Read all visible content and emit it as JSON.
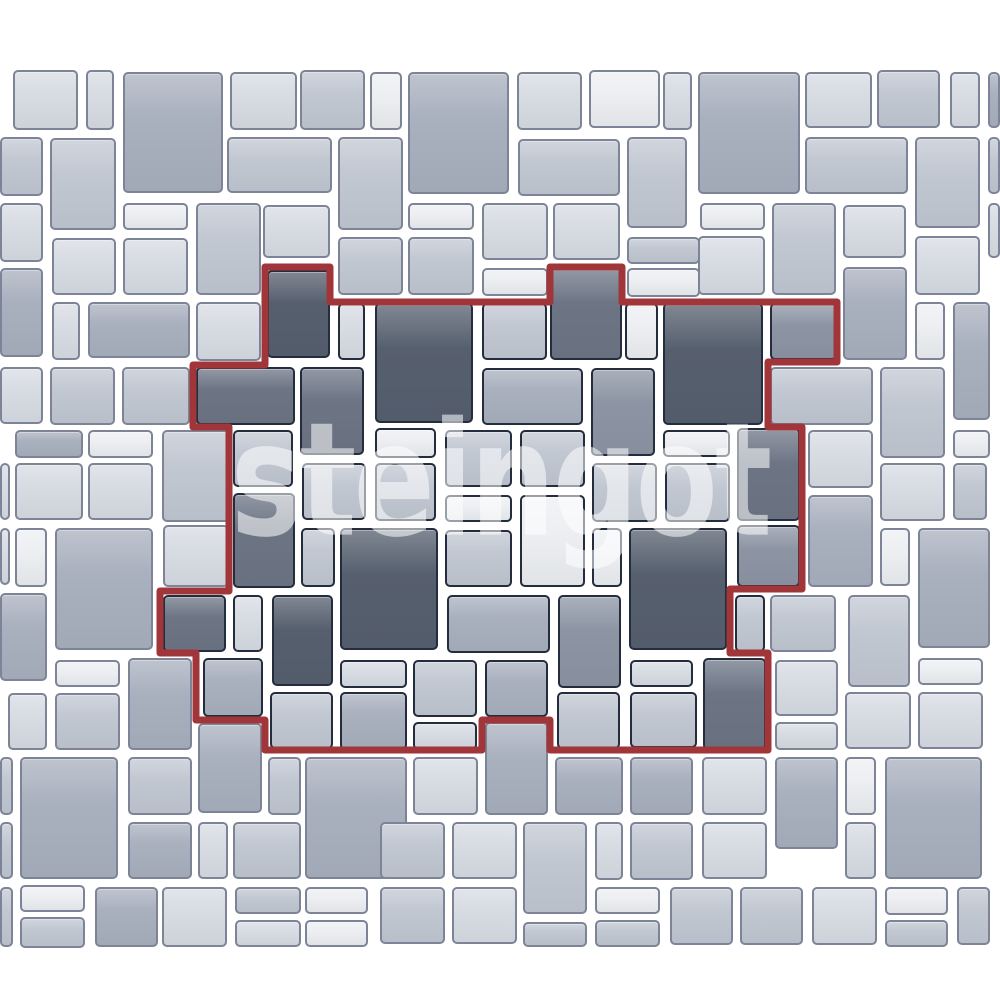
{
  "image": {
    "width": 1000,
    "height": 1000,
    "background": "#ffffff"
  },
  "watermark": {
    "text": "steingot"
  },
  "palette": {
    "shades": [
      "#edeff2",
      "#d8dce3",
      "#c2c8d2",
      "#a9b0be",
      "#8d95a4",
      "#6d7585",
      "#565f6e"
    ],
    "tile_border_outside": "#7d8497",
    "tile_border_inside": "#232d3d",
    "pattern_outline_red": "#a03639",
    "watermark_color": "rgba(255,255,255,0.55)"
  },
  "pattern_outline": {
    "stroke_width": 7,
    "points": [
      [
        265,
        267
      ],
      [
        330,
        267
      ],
      [
        330,
        302
      ],
      [
        550,
        302
      ],
      [
        550,
        267
      ],
      [
        622,
        267
      ],
      [
        622,
        302
      ],
      [
        837,
        302
      ],
      [
        837,
        362
      ],
      [
        768,
        362
      ],
      [
        768,
        427
      ],
      [
        802,
        427
      ],
      [
        802,
        589
      ],
      [
        730,
        589
      ],
      [
        730,
        653
      ],
      [
        768,
        653
      ],
      [
        768,
        750
      ],
      [
        550,
        750
      ],
      [
        550,
        720
      ],
      [
        482,
        720
      ],
      [
        482,
        750
      ],
      [
        265,
        750
      ],
      [
        265,
        720
      ],
      [
        196,
        720
      ],
      [
        196,
        653
      ],
      [
        160,
        653
      ],
      [
        160,
        591
      ],
      [
        229,
        591
      ],
      [
        229,
        427
      ],
      [
        193,
        427
      ],
      [
        193,
        365
      ],
      [
        265,
        365
      ]
    ]
  },
  "tiles": [
    [
      13,
      70,
      65,
      60,
      1,
      0
    ],
    [
      86,
      70,
      28,
      60,
      1,
      0
    ],
    [
      123,
      72,
      100,
      121,
      3,
      0
    ],
    [
      230,
      72,
      67,
      58,
      1,
      0
    ],
    [
      300,
      70,
      65,
      60,
      2,
      0
    ],
    [
      370,
      72,
      32,
      58,
      0,
      0
    ],
    [
      408,
      72,
      101,
      122,
      3,
      0
    ],
    [
      517,
      72,
      65,
      58,
      1,
      0
    ],
    [
      589,
      70,
      71,
      58,
      0,
      0
    ],
    [
      663,
      72,
      29,
      58,
      1,
      0
    ],
    [
      698,
      72,
      102,
      122,
      3,
      0
    ],
    [
      805,
      72,
      67,
      56,
      1,
      0
    ],
    [
      877,
      70,
      63,
      58,
      2,
      0
    ],
    [
      950,
      72,
      30,
      56,
      1,
      0
    ],
    [
      988,
      72,
      12,
      56,
      3,
      0
    ],
    [
      0,
      137,
      43,
      59,
      2,
      0
    ],
    [
      50,
      138,
      66,
      92,
      2,
      0
    ],
    [
      227,
      137,
      105,
      56,
      2,
      0
    ],
    [
      338,
      137,
      65,
      93,
      2,
      0
    ],
    [
      518,
      139,
      102,
      57,
      2,
      0
    ],
    [
      627,
      137,
      60,
      91,
      2,
      0
    ],
    [
      805,
      137,
      103,
      57,
      2,
      0
    ],
    [
      915,
      137,
      65,
      91,
      2,
      0
    ],
    [
      988,
      137,
      12,
      57,
      2,
      0
    ],
    [
      0,
      203,
      43,
      59,
      1,
      0
    ],
    [
      123,
      203,
      65,
      27,
      0,
      0
    ],
    [
      196,
      203,
      65,
      92,
      2,
      0
    ],
    [
      263,
      205,
      67,
      53,
      1,
      0
    ],
    [
      408,
      203,
      66,
      27,
      0,
      0
    ],
    [
      482,
      203,
      66,
      57,
      1,
      0
    ],
    [
      553,
      203,
      67,
      57,
      1,
      0
    ],
    [
      700,
      203,
      65,
      27,
      0,
      0
    ],
    [
      772,
      203,
      64,
      92,
      2,
      0
    ],
    [
      843,
      205,
      63,
      53,
      1,
      0
    ],
    [
      988,
      203,
      12,
      55,
      1,
      0
    ],
    [
      0,
      268,
      43,
      89,
      3,
      0
    ],
    [
      52,
      238,
      64,
      57,
      1,
      0
    ],
    [
      123,
      238,
      65,
      57,
      1,
      0
    ],
    [
      338,
      237,
      65,
      58,
      2,
      0
    ],
    [
      408,
      237,
      66,
      58,
      2,
      0
    ],
    [
      482,
      268,
      66,
      28,
      0,
      0
    ],
    [
      627,
      237,
      73,
      27,
      2,
      0
    ],
    [
      627,
      268,
      73,
      29,
      0,
      0
    ],
    [
      698,
      236,
      67,
      59,
      1,
      0
    ],
    [
      843,
      267,
      64,
      93,
      3,
      0
    ],
    [
      915,
      236,
      65,
      59,
      1,
      0
    ],
    [
      52,
      302,
      28,
      58,
      1,
      0
    ],
    [
      88,
      302,
      102,
      56,
      3,
      0
    ],
    [
      196,
      302,
      65,
      59,
      1,
      0
    ],
    [
      915,
      302,
      30,
      58,
      0,
      0
    ],
    [
      953,
      302,
      37,
      118,
      3,
      0
    ],
    [
      267,
      270,
      63,
      88,
      6,
      1
    ],
    [
      550,
      268,
      72,
      92,
      5,
      1
    ],
    [
      338,
      303,
      27,
      57,
      1,
      1
    ],
    [
      375,
      303,
      98,
      120,
      6,
      1
    ],
    [
      482,
      303,
      65,
      57,
      2,
      1
    ],
    [
      625,
      303,
      33,
      57,
      0,
      1
    ],
    [
      663,
      303,
      100,
      122,
      6,
      1
    ],
    [
      770,
      303,
      67,
      57,
      4,
      1
    ],
    [
      196,
      367,
      99,
      58,
      5,
      1
    ],
    [
      300,
      367,
      64,
      88,
      5,
      1
    ],
    [
      482,
      368,
      101,
      57,
      3,
      1
    ],
    [
      591,
      368,
      64,
      88,
      4,
      1
    ],
    [
      233,
      430,
      60,
      57,
      2,
      1
    ],
    [
      375,
      428,
      61,
      30,
      0,
      1
    ],
    [
      445,
      430,
      67,
      57,
      2,
      1
    ],
    [
      520,
      430,
      65,
      57,
      2,
      1
    ],
    [
      663,
      430,
      67,
      27,
      0,
      1
    ],
    [
      737,
      428,
      63,
      93,
      5,
      1
    ],
    [
      233,
      493,
      62,
      95,
      5,
      1
    ],
    [
      302,
      463,
      64,
      57,
      2,
      1
    ],
    [
      375,
      463,
      61,
      58,
      2,
      1
    ],
    [
      445,
      495,
      67,
      27,
      0,
      1
    ],
    [
      520,
      495,
      65,
      92,
      0,
      1
    ],
    [
      592,
      463,
      65,
      59,
      2,
      1
    ],
    [
      665,
      463,
      65,
      59,
      2,
      1
    ],
    [
      301,
      528,
      34,
      59,
      2,
      1
    ],
    [
      340,
      528,
      98,
      122,
      6,
      1
    ],
    [
      445,
      530,
      67,
      57,
      2,
      1
    ],
    [
      592,
      528,
      30,
      59,
      0,
      1
    ],
    [
      629,
      528,
      98,
      122,
      6,
      1
    ],
    [
      737,
      525,
      63,
      62,
      4,
      1
    ],
    [
      163,
      595,
      63,
      57,
      5,
      1
    ],
    [
      233,
      595,
      30,
      57,
      1,
      1
    ],
    [
      272,
      595,
      61,
      91,
      6,
      1
    ],
    [
      447,
      595,
      103,
      58,
      3,
      1
    ],
    [
      558,
      595,
      63,
      93,
      4,
      1
    ],
    [
      735,
      595,
      30,
      57,
      2,
      1
    ],
    [
      203,
      658,
      60,
      59,
      3,
      1
    ],
    [
      270,
      692,
      63,
      57,
      2,
      1
    ],
    [
      340,
      660,
      67,
      28,
      1,
      1
    ],
    [
      340,
      692,
      67,
      58,
      3,
      1
    ],
    [
      413,
      660,
      64,
      57,
      2,
      1
    ],
    [
      413,
      722,
      64,
      28,
      1,
      1
    ],
    [
      485,
      660,
      63,
      57,
      3,
      1
    ],
    [
      557,
      692,
      63,
      57,
      2,
      1
    ],
    [
      630,
      660,
      63,
      27,
      1,
      1
    ],
    [
      630,
      692,
      67,
      56,
      2,
      1
    ],
    [
      703,
      658,
      63,
      92,
      5,
      1
    ],
    [
      0,
      367,
      43,
      57,
      1,
      0
    ],
    [
      50,
      367,
      65,
      58,
      2,
      0
    ],
    [
      122,
      367,
      68,
      58,
      2,
      0
    ],
    [
      15,
      430,
      68,
      28,
      3,
      0
    ],
    [
      88,
      430,
      65,
      28,
      0,
      0
    ],
    [
      162,
      430,
      68,
      92,
      2,
      0
    ],
    [
      0,
      463,
      10,
      57,
      1,
      0
    ],
    [
      15,
      463,
      68,
      57,
      1,
      0
    ],
    [
      88,
      463,
      65,
      57,
      1,
      0
    ],
    [
      0,
      528,
      10,
      57,
      1,
      0
    ],
    [
      15,
      528,
      32,
      59,
      0,
      0
    ],
    [
      55,
      528,
      98,
      122,
      3,
      0
    ],
    [
      163,
      525,
      66,
      62,
      1,
      0
    ],
    [
      0,
      593,
      47,
      88,
      3,
      0
    ],
    [
      55,
      660,
      65,
      27,
      0,
      0
    ],
    [
      8,
      693,
      39,
      57,
      1,
      0
    ],
    [
      55,
      693,
      65,
      57,
      2,
      0
    ],
    [
      128,
      658,
      64,
      92,
      3,
      0
    ],
    [
      198,
      723,
      64,
      90,
      3,
      0
    ],
    [
      0,
      757,
      13,
      58,
      2,
      0
    ],
    [
      20,
      757,
      98,
      122,
      3,
      0
    ],
    [
      128,
      757,
      64,
      58,
      2,
      0
    ],
    [
      268,
      757,
      33,
      58,
      2,
      0
    ],
    [
      305,
      757,
      102,
      122,
      3,
      0
    ],
    [
      128,
      822,
      64,
      57,
      3,
      0
    ],
    [
      198,
      822,
      30,
      57,
      1,
      0
    ],
    [
      233,
      822,
      68,
      57,
      2,
      0
    ],
    [
      0,
      822,
      13,
      57,
      2,
      0
    ],
    [
      0,
      887,
      13,
      60,
      2,
      0
    ],
    [
      20,
      885,
      65,
      27,
      0,
      0
    ],
    [
      20,
      917,
      65,
      31,
      2,
      0
    ],
    [
      95,
      887,
      63,
      60,
      3,
      0
    ],
    [
      162,
      887,
      65,
      60,
      1,
      0
    ],
    [
      235,
      887,
      66,
      27,
      2,
      0
    ],
    [
      235,
      920,
      66,
      27,
      1,
      0
    ],
    [
      305,
      887,
      63,
      27,
      0,
      0
    ],
    [
      305,
      920,
      63,
      27,
      0,
      0
    ],
    [
      485,
      722,
      63,
      93,
      3,
      0
    ],
    [
      413,
      757,
      65,
      58,
      1,
      0
    ],
    [
      555,
      757,
      68,
      58,
      3,
      0
    ],
    [
      630,
      757,
      63,
      58,
      3,
      0
    ],
    [
      380,
      822,
      65,
      57,
      2,
      0
    ],
    [
      452,
      822,
      65,
      57,
      1,
      0
    ],
    [
      523,
      822,
      64,
      92,
      2,
      0
    ],
    [
      595,
      822,
      28,
      58,
      1,
      0
    ],
    [
      630,
      822,
      63,
      58,
      2,
      0
    ],
    [
      702,
      822,
      65,
      57,
      1,
      0
    ],
    [
      380,
      887,
      65,
      57,
      2,
      0
    ],
    [
      452,
      887,
      65,
      57,
      1,
      0
    ],
    [
      523,
      922,
      64,
      25,
      2,
      0
    ],
    [
      595,
      887,
      65,
      27,
      0,
      0
    ],
    [
      595,
      920,
      65,
      27,
      2,
      0
    ],
    [
      775,
      660,
      63,
      56,
      1,
      0
    ],
    [
      775,
      722,
      63,
      28,
      1,
      0
    ],
    [
      845,
      692,
      66,
      57,
      1,
      0
    ],
    [
      918,
      658,
      65,
      27,
      0,
      0
    ],
    [
      918,
      692,
      65,
      57,
      1,
      0
    ],
    [
      702,
      757,
      65,
      58,
      1,
      0
    ],
    [
      775,
      757,
      63,
      92,
      3,
      0
    ],
    [
      845,
      757,
      31,
      58,
      0,
      0
    ],
    [
      885,
      757,
      97,
      122,
      3,
      0
    ],
    [
      845,
      822,
      31,
      57,
      1,
      0
    ],
    [
      670,
      887,
      63,
      58,
      2,
      0
    ],
    [
      740,
      887,
      63,
      58,
      2,
      0
    ],
    [
      812,
      887,
      65,
      58,
      1,
      0
    ],
    [
      885,
      887,
      63,
      28,
      0,
      0
    ],
    [
      885,
      920,
      63,
      27,
      2,
      0
    ],
    [
      957,
      887,
      33,
      58,
      2,
      0
    ],
    [
      770,
      367,
      103,
      58,
      2,
      0
    ],
    [
      880,
      367,
      65,
      91,
      2,
      0
    ],
    [
      953,
      430,
      37,
      28,
      0,
      0
    ],
    [
      808,
      430,
      65,
      58,
      1,
      0
    ],
    [
      880,
      463,
      65,
      58,
      1,
      0
    ],
    [
      953,
      463,
      34,
      57,
      2,
      0
    ],
    [
      808,
      495,
      65,
      92,
      3,
      0
    ],
    [
      880,
      528,
      30,
      58,
      0,
      0
    ],
    [
      918,
      528,
      72,
      120,
      3,
      0
    ],
    [
      848,
      595,
      62,
      92,
      2,
      0
    ],
    [
      770,
      595,
      66,
      57,
      2,
      0
    ]
  ]
}
